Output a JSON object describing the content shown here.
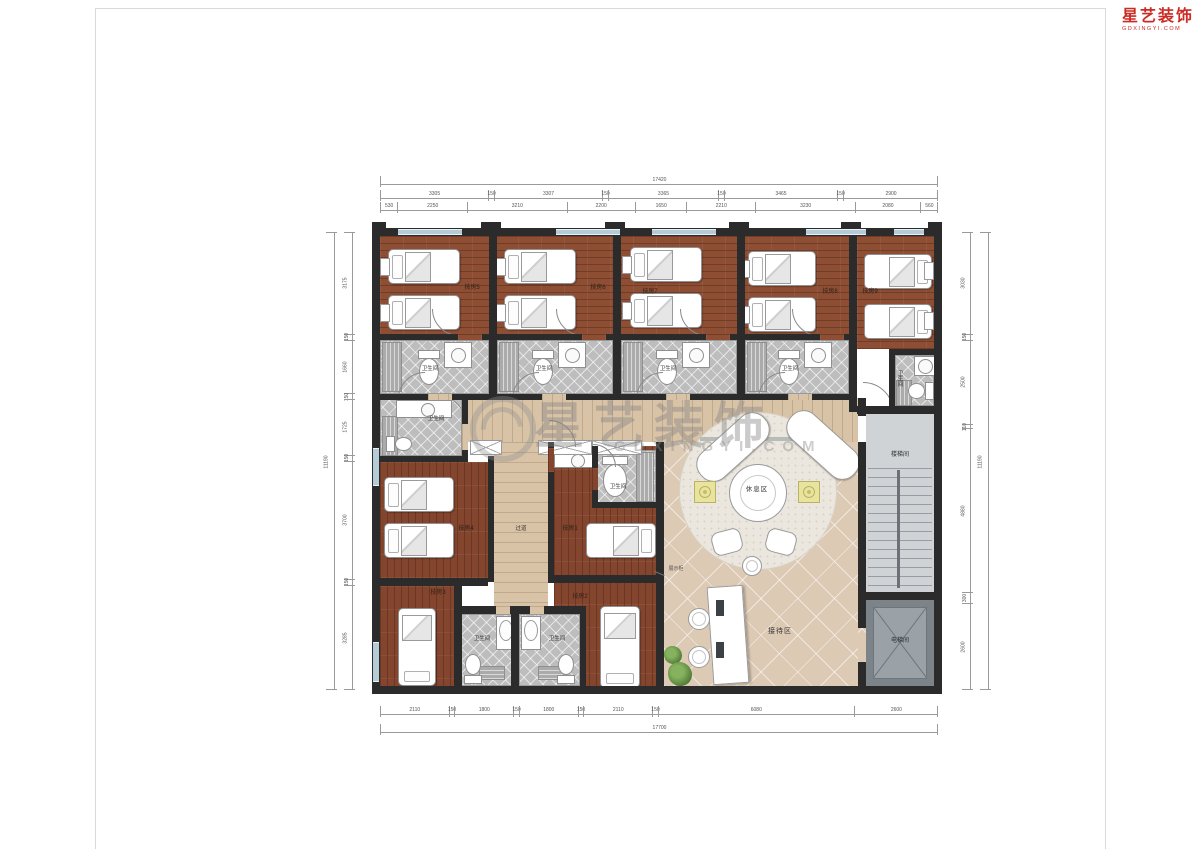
{
  "brand": {
    "name": "星艺装饰",
    "domain": "GDXINGYI.COM"
  },
  "watermark": {
    "text": "星艺装饰",
    "subtext": "GDXINGYI.COM"
  },
  "rooms": [
    {
      "label": "技房1"
    },
    {
      "label": "技房2"
    },
    {
      "label": "技房3"
    },
    {
      "label": "技房4"
    },
    {
      "label": "技房5"
    },
    {
      "label": "技房6"
    },
    {
      "label": "技房7"
    },
    {
      "label": "技房8"
    },
    {
      "label": "技房9"
    }
  ],
  "labels": {
    "bathroom": "卫生间",
    "corridor": "过道",
    "rest_area": "休息区",
    "reception": "接待区",
    "stairwell": "楼梯间",
    "elevator": "电梯间",
    "display_cabinet": "展示柜"
  },
  "dimensions": {
    "top": {
      "total": "17420",
      "outer": [
        "3305",
        "150",
        "3307",
        "150",
        "3365",
        "150",
        "3465",
        "150",
        "2900"
      ],
      "inner": [
        "530",
        "2250",
        "3210",
        "2200",
        "1650",
        "2210",
        "3230",
        "2080",
        "560"
      ]
    },
    "bottom": {
      "total": "17700",
      "row": [
        "2110",
        "150",
        "1800",
        "150",
        "1800",
        "150",
        "2110",
        "150",
        "6080",
        "2600"
      ]
    },
    "left": {
      "total": "11190",
      "row": [
        "3175",
        "150",
        "1660",
        "150",
        "1725",
        "150",
        "3700",
        "150",
        "3285"
      ]
    },
    "right": {
      "total": "11190",
      "row": [
        "3030",
        "150",
        "2500",
        "110",
        "4880",
        "300",
        "2600"
      ]
    }
  }
}
